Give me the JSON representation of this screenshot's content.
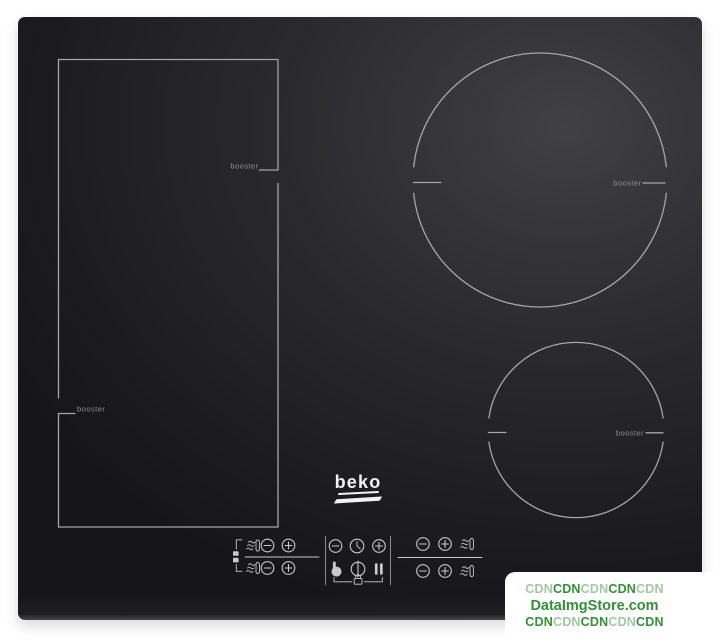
{
  "brand": {
    "logo_text": "beko"
  },
  "zones": {
    "flex_left": {
      "booster_top": "booster",
      "booster_bottom": "booster"
    },
    "top_right": {
      "booster": "booster"
    },
    "bottom_right": {
      "booster": "booster"
    }
  },
  "controls": {
    "flex_link_indicator_icon": "bridge-link-icon",
    "flex_zone_top": {
      "icons": [
        "heat-indicator-icon",
        "minus-button",
        "plus-button"
      ]
    },
    "flex_zone_bottom": {
      "icons": [
        "heat-indicator-icon",
        "minus-button",
        "plus-button"
      ]
    },
    "timer": {
      "icons": [
        "minus-button",
        "clock-icon",
        "plus-button"
      ]
    },
    "center": {
      "icons": [
        "hand-touch-button",
        "power-button",
        "pause-button",
        "key-lock-indicator-icon"
      ]
    },
    "zone_top_right": {
      "icons": [
        "minus-button",
        "plus-button",
        "heat-indicator-icon"
      ]
    },
    "zone_bottom_right": {
      "icons": [
        "minus-button",
        "plus-button",
        "heat-indicator-icon"
      ]
    }
  },
  "watermark": {
    "line1_segments": [
      {
        "text": "CDN",
        "tone": "light"
      },
      {
        "text": "CDN",
        "tone": "dark"
      },
      {
        "text": "CDN",
        "tone": "light"
      },
      {
        "text": "CDN",
        "tone": "dark"
      },
      {
        "text": "CDN",
        "tone": "light"
      }
    ],
    "line2": "DataImgStore.com",
    "line3_segments": [
      {
        "text": "CDN",
        "tone": "dark"
      },
      {
        "text": "CDN",
        "tone": "light"
      },
      {
        "text": "CDN",
        "tone": "dark"
      },
      {
        "text": "CDN",
        "tone": "light"
      },
      {
        "text": "CDN",
        "tone": "dark"
      }
    ]
  },
  "colors": {
    "background": "#ffffff",
    "glass_base": "#1d1d1f",
    "glass_highlight": "#404045",
    "zone_line": "#a6a6a6",
    "booster_text": "#8f8f8f",
    "control_line": "#c9c9c9",
    "separator_line": "#8c8c8c",
    "logo": "#f2f2f2",
    "wm_light": "#a4c7a4",
    "wm_dark": "#2e9431"
  }
}
